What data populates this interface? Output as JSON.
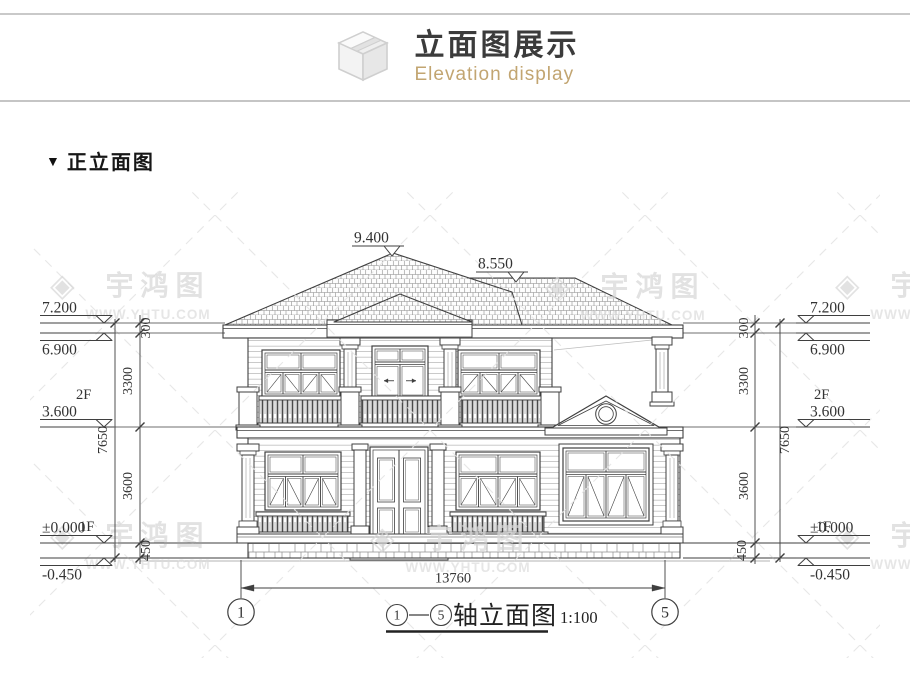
{
  "header": {
    "title": "立面图展示",
    "subtitle": "Elevation display",
    "icon": "box-3d-icon",
    "accent_color": "#c2a571",
    "title_color": "#3b3b3b"
  },
  "section": {
    "marker": "▼",
    "label": "正立面图"
  },
  "drawing": {
    "roof_levels": [
      "9.400",
      "8.550"
    ],
    "level_values": [
      "7.200",
      "6.900",
      "3.600",
      "±0.000",
      "-0.450"
    ],
    "floor_labels": [
      "2F",
      "1F"
    ],
    "vertical_dims": [
      "300",
      "3300",
      "3600",
      "450"
    ],
    "overall_height_dim": "7650",
    "overall_width_dim": "13760",
    "axis_bubbles": [
      "1",
      "5"
    ],
    "axis_title_text": "轴立面图",
    "axis_title_full": "①-⑤轴立面图",
    "axis_title_scale": "1:100",
    "line_color": "#3f3f3f"
  },
  "watermark": {
    "logo_glyph": "◈",
    "brand": "宇鸿图",
    "url": "WWW.YHTU.COM",
    "color": "#d7d7d7"
  }
}
